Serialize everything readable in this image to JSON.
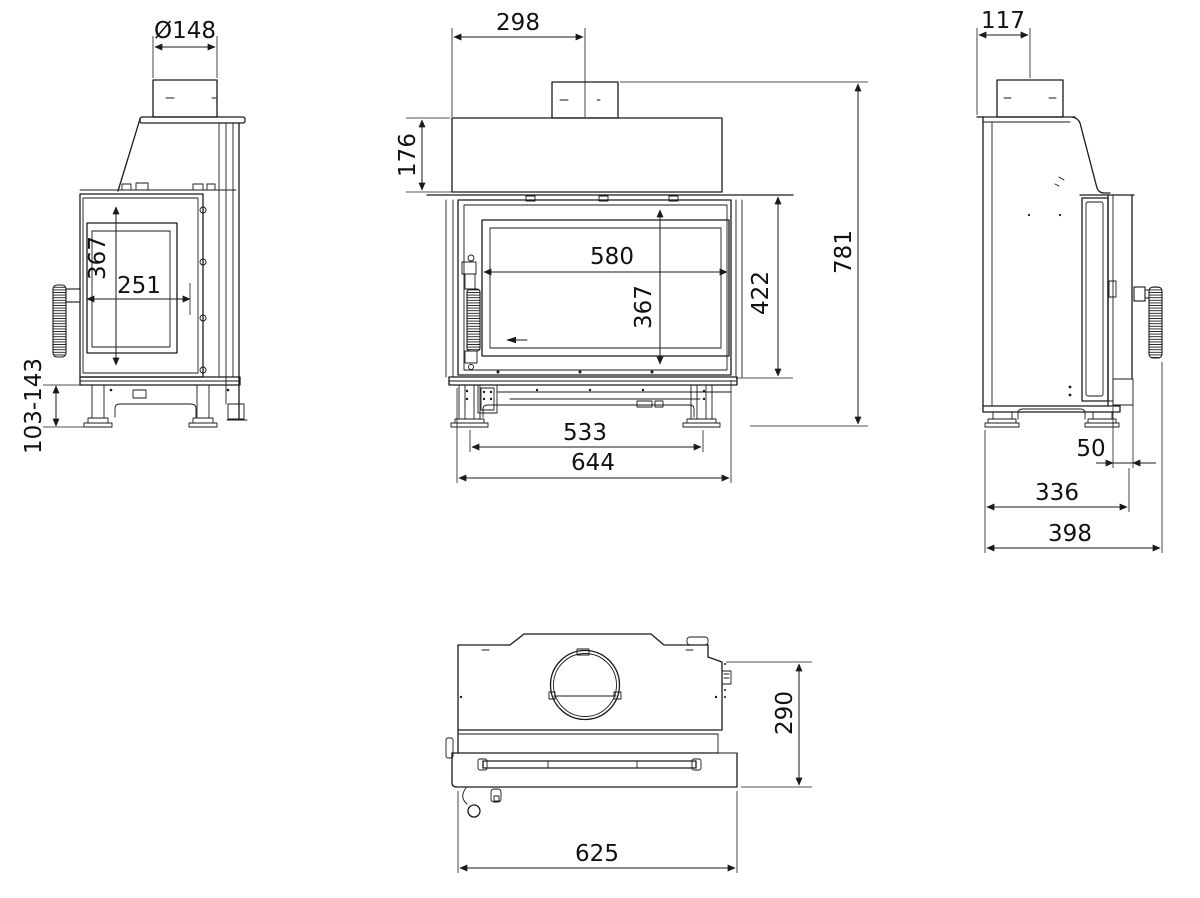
{
  "drawing": {
    "type": "technical-dimension-drawing",
    "subject": "fireplace insert stove, four orthographic views",
    "unit": "mm",
    "views": {
      "left": {
        "name": "left-side-view",
        "dims": {
          "flue_diameter": "Ø148",
          "glass_height": "367",
          "glass_width": "251",
          "leg_height_range": "103-143"
        }
      },
      "front": {
        "name": "front-view",
        "dims": {
          "flue_center_offset": "298",
          "hood_height": "176",
          "glass_width": "580",
          "glass_height": "367",
          "door_height": "422",
          "overall_height": "781",
          "feet_spacing": "533",
          "overall_width": "644"
        }
      },
      "right": {
        "name": "right-side-view",
        "dims": {
          "flue_center_offset": "117",
          "door_front_offset": "50",
          "body_depth": "336",
          "overall_depth": "398"
        }
      },
      "top": {
        "name": "top-view",
        "dims": {
          "body_depth": "290",
          "body_width": "625"
        }
      }
    }
  }
}
